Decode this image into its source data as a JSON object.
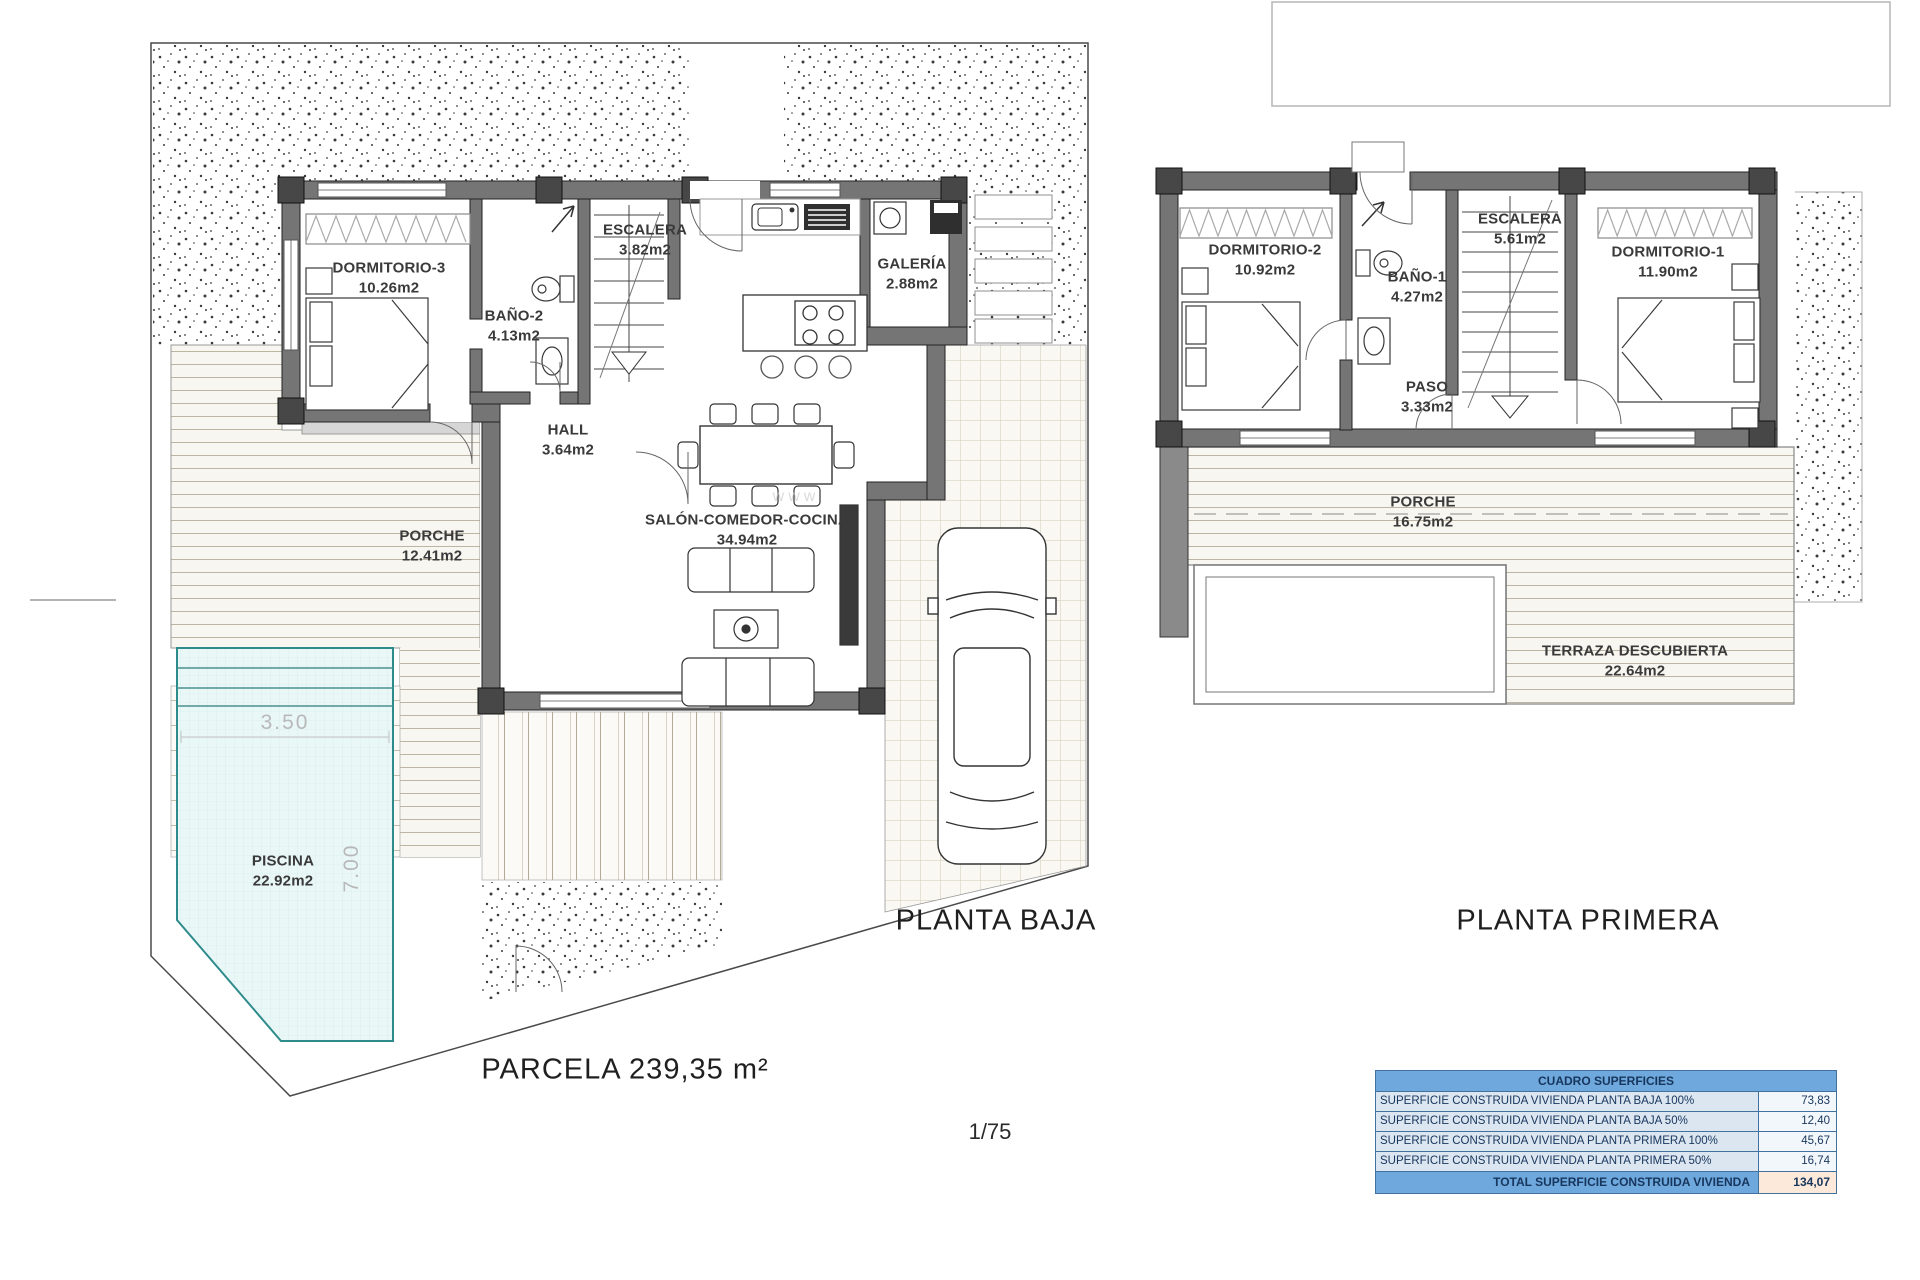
{
  "watermark": "www",
  "plans": {
    "planta_baja": {
      "title": "PLANTA BAJA",
      "rooms": {
        "dormitorio3": {
          "name": "DORMITORIO-3",
          "area": "10.26m2"
        },
        "bano2": {
          "name": "BAÑO-2",
          "area": "4.13m2"
        },
        "escalera": {
          "name": "ESCALERA",
          "area": "3.82m2"
        },
        "galeria": {
          "name": "GALERÍA",
          "area": "2.88m2"
        },
        "hall": {
          "name": "HALL",
          "area": "3.64m2"
        },
        "salon": {
          "name": "SALÓN-COMEDOR-COCINA",
          "area": "34.94m2"
        },
        "porche": {
          "name": "PORCHE",
          "area": "12.41m2"
        },
        "piscina": {
          "name": "PISCINA",
          "area": "22.92m2"
        }
      },
      "pool_dims": {
        "width": "3.50",
        "depth": "7.00"
      }
    },
    "planta_primera": {
      "title": "PLANTA PRIMERA",
      "rooms": {
        "dormitorio2": {
          "name": "DORMITORIO-2",
          "area": "10.92m2"
        },
        "bano1": {
          "name": "BAÑO-1",
          "area": "4.27m2"
        },
        "escalera": {
          "name": "ESCALERA",
          "area": "5.61m2"
        },
        "dormitorio1": {
          "name": "DORMITORIO-1",
          "area": "11.90m2"
        },
        "paso": {
          "name": "PASO",
          "area": "3.33m2"
        },
        "porche": {
          "name": "PORCHE",
          "area": "16.75m2"
        },
        "terraza": {
          "name": "TERRAZA DESCUBIERTA",
          "area": "22.64m2"
        }
      }
    }
  },
  "footer": {
    "parcela": "PARCELA 239,35 m²",
    "scale": "1/75"
  },
  "table": {
    "title": "CUADRO SUPERFICIES",
    "rows": [
      {
        "label": "SUPERFICIE CONSTRUIDA VIVIENDA PLANTA BAJA 100%",
        "value": "73,83"
      },
      {
        "label": "SUPERFICIE CONSTRUIDA VIVIENDA PLANTA BAJA 50%",
        "value": "12,40"
      },
      {
        "label": "SUPERFICIE CONSTRUIDA VIVIENDA PLANTA PRIMERA 100%",
        "value": "45,67"
      },
      {
        "label": "SUPERFICIE CONSTRUIDA VIVIENDA PLANTA PRIMERA 50%",
        "value": "16,74"
      }
    ],
    "total": {
      "label": "TOTAL SUPERFICIE CONSTRUIDA VIVIENDA",
      "value": "134,07"
    }
  }
}
